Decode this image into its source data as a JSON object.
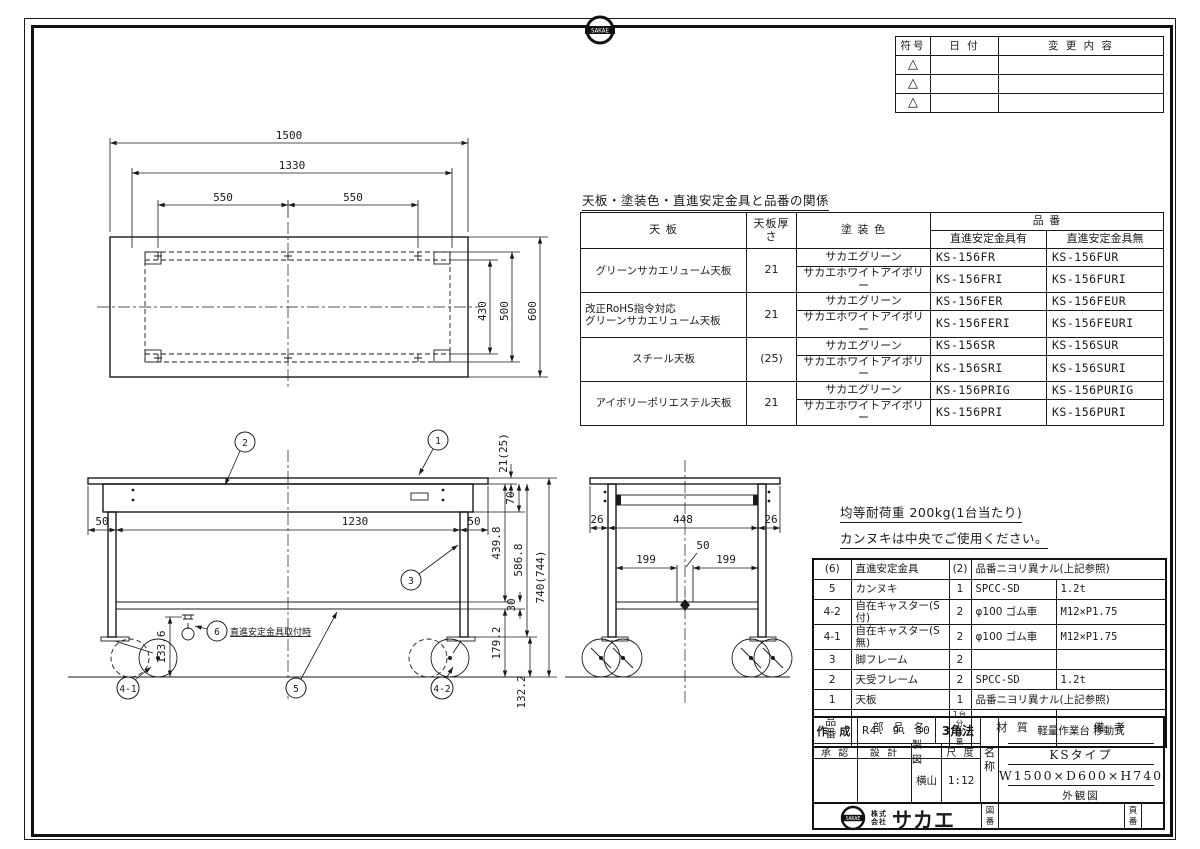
{
  "sheet": {
    "badge_text": "SAKAE",
    "company_prefix_1": "株式",
    "company_prefix_2": "会社",
    "company_name": "サカエ"
  },
  "revision": {
    "h_symbol": "符号",
    "h_date": "日 付",
    "h_change": "変 更 内 容",
    "triangle": "△"
  },
  "spec": {
    "title": "天板・塗装色・直進安定金具と品番の関係",
    "h_top": "天 板",
    "h_thk": "天板厚さ",
    "h_color": "塗 装 色",
    "h_part": "品 番",
    "h_with": "直進安定金具有",
    "h_without": "直進安定金具無",
    "groups": [
      {
        "top1": "グリーンサカエリューム天板",
        "top2": "",
        "thk": "21",
        "colors": [
          "サカエグリーン",
          "サカエホワイトアイボリー"
        ],
        "with": [
          "KS-156FR",
          "KS-156FRI"
        ],
        "without": [
          "KS-156FUR",
          "KS-156FURI"
        ]
      },
      {
        "top1": "改正RoHS指令対応",
        "top2": "グリーンサカエリューム天板",
        "thk": "21",
        "colors": [
          "サカエグリーン",
          "サカエホワイトアイボリー"
        ],
        "with": [
          "KS-156FER",
          "KS-156FERI"
        ],
        "without": [
          "KS-156FEUR",
          "KS-156FEURI"
        ]
      },
      {
        "top1": "スチール天板",
        "top2": "",
        "thk": "(25)",
        "colors": [
          "サカエグリーン",
          "サカエホワイトアイボリー"
        ],
        "with": [
          "KS-156SR",
          "KS-156SRI"
        ],
        "without": [
          "KS-156SUR",
          "KS-156SURI"
        ]
      },
      {
        "top1": "アイボリーポリエステル天板",
        "top2": "",
        "thk": "21",
        "colors": [
          "サカエグリーン",
          "サカエホワイトアイボリー"
        ],
        "with": [
          "KS-156PRIG",
          "KS-156PRI"
        ],
        "without": [
          "KS-156PURIG",
          "KS-156PURI"
        ]
      }
    ]
  },
  "notes": {
    "load": "均等耐荷重 200kg(1台当たり)",
    "kannuki": "カンヌキは中央でご使用ください。"
  },
  "parts": {
    "h_no": "品 番",
    "h_name": "部 品 名",
    "h_qty1": "1台分",
    "h_qty2": "数 量",
    "h_mat": "材 質",
    "h_rem": "備 考",
    "rows": [
      {
        "no": "(6)",
        "name": "直進安定金具",
        "qty": "(2)",
        "mat": "品番ニヨリ異ナル(上記参照)",
        "rem": ""
      },
      {
        "no": "5",
        "name": "カンヌキ",
        "qty": "1",
        "mat": "SPCC-SD",
        "rem": "1.2t"
      },
      {
        "no": "4-2",
        "name": "自在キャスター(S付)",
        "qty": "2",
        "mat": "φ100 ゴム車",
        "rem": "M12×P1.75"
      },
      {
        "no": "4-1",
        "name": "自在キャスター(S無)",
        "qty": "2",
        "mat": "φ100 ゴム車",
        "rem": "M12×P1.75"
      },
      {
        "no": "3",
        "name": "脚フレーム",
        "qty": "2",
        "mat": "",
        "rem": ""
      },
      {
        "no": "2",
        "name": "天受フレーム",
        "qty": "2",
        "mat": "SPCC-SD",
        "rem": "1.2t"
      },
      {
        "no": "1",
        "name": "天板",
        "qty": "1",
        "mat": "品番ニヨリ異ナル(上記参照)",
        "rem": ""
      }
    ]
  },
  "titleblock": {
    "created_label": "作 成",
    "created_value": "R4. 9. 30",
    "method": "3角法",
    "approved_label": "承 認",
    "design_label": "設 計",
    "draft_label": "製 図",
    "scale_label": "尺 度",
    "draft_value": "横山",
    "scale_value": "1:12",
    "name_1": "名",
    "name_2": "称",
    "product_line1": "軽量作業台 移動式",
    "product_line2": "KSタイプ",
    "product_line3": "W1500×D600×H740",
    "product_line4": "外観図",
    "zuban_1": "図",
    "zuban_2": "番",
    "page_1": "頁",
    "page_2": "番"
  },
  "views": {
    "top": {
      "w": "1500",
      "w_inner": "1330",
      "w_half_l": "550",
      "w_half_r": "550",
      "d_inner": "430",
      "d_mid": "500",
      "d": "600"
    },
    "front": {
      "oh_l": "50",
      "span": "1230",
      "oh_r": "50",
      "thk": "21(25)",
      "apron": "70",
      "under": "439.8",
      "leg": "586.8",
      "height": "740(744)",
      "shelf_thk": "30",
      "shelf_h": "179.2",
      "caster_h": "132.2",
      "stab_h": "133.6",
      "b1": "1",
      "b2": "2",
      "b3": "3",
      "b5": "5",
      "b41": "4-1",
      "b42": "4-2",
      "b6": "6",
      "b6_note": "直進安定金具取付時"
    },
    "side": {
      "oh_l": "26",
      "span": "448",
      "oh_r": "26",
      "slot": "50",
      "off_l": "199",
      "off_r": "199"
    }
  }
}
